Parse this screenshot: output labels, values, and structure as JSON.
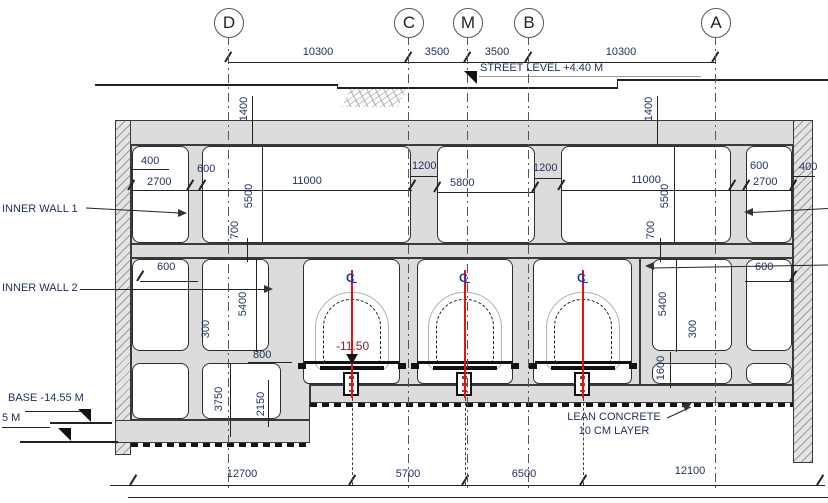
{
  "drawing": {
    "type": "metro-station-cross-section",
    "grid": {
      "labels": [
        "D",
        "C",
        "M",
        "B",
        "A"
      ]
    },
    "top_dims": {
      "dc": "10300",
      "cm": "3500",
      "mb": "3500",
      "ba": "10300"
    },
    "street": {
      "label": "STREET LEVEL +4.40 M"
    },
    "walls": {
      "inner1": "INNER WALL 1",
      "inner2": "INNER WALL 2"
    },
    "lean": {
      "line1": "LEAN CONCRETE",
      "line2": "10 CM LAYER"
    },
    "levels": {
      "tunnel": "-11.50",
      "base": "BASE -14.55 M",
      "base_partial": "5 M"
    },
    "dims": {
      "d1400": "1400",
      "d400": "400",
      "d2700": "2700",
      "d600": "600",
      "d5500": "5500",
      "d11000": "11000",
      "d700": "700",
      "d1200": "1200",
      "d5800": "5800",
      "d5400": "5400",
      "d300": "300",
      "d800": "800",
      "d3750": "3750",
      "d2150": "2150",
      "d1600": "1600"
    },
    "bottom_dims": {
      "b1": "12700",
      "b2": "5700",
      "b3": "6500",
      "b4": "12100"
    },
    "colors": {
      "ink": "#1e2f5e",
      "concrete": "#dcdcdc",
      "centerline_red": "#e01212",
      "cl_symbol_blue": "#2233aa"
    }
  }
}
